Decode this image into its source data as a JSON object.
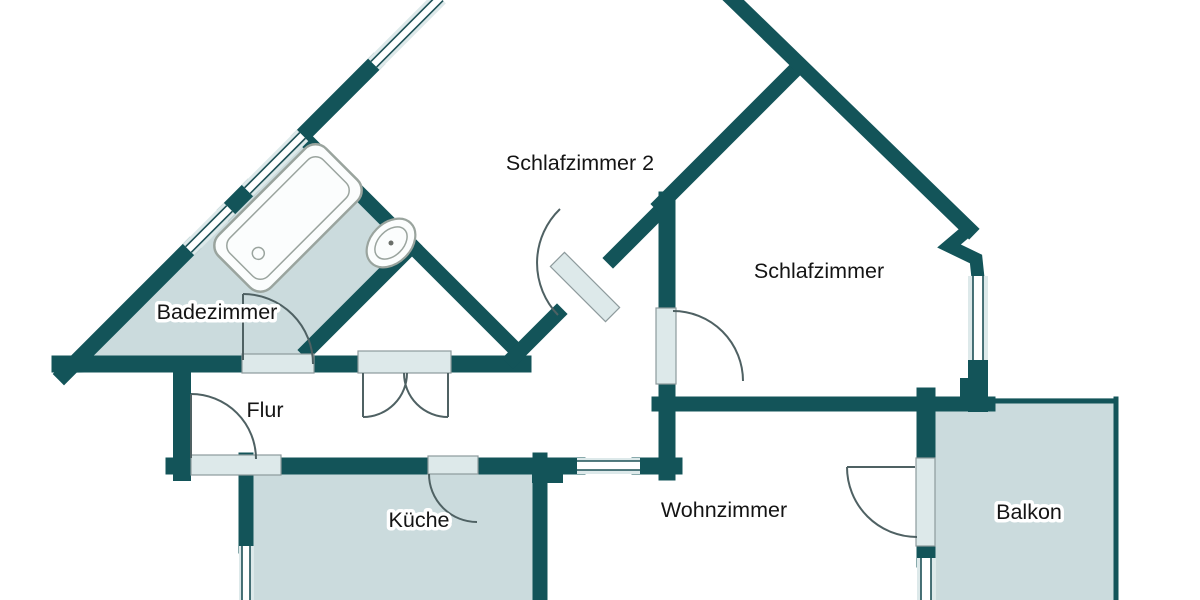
{
  "plan": {
    "type": "apartment-floor-plan",
    "rooms": {
      "schlafzimmer2": {
        "label": "Schlafzimmer 2"
      },
      "schlafzimmer": {
        "label": "Schlafzimmer"
      },
      "badezimmer": {
        "label": "Badezimmer"
      },
      "flur": {
        "label": "Flur"
      },
      "kueche": {
        "label": "Küche"
      },
      "wohnzimmer": {
        "label": "Wohnzimmer"
      },
      "balkon": {
        "label": "Balkon"
      }
    },
    "fixtures": {
      "bathtub": "bathtub-icon",
      "sink": "sink-icon"
    }
  },
  "colors": {
    "wall": "#135459",
    "room_fill": "#cbdbdd",
    "sill_fill": "#dde9ea",
    "fixture_outline": "#9aa49e",
    "arc_line": "#4f6163",
    "window_line": "#1d5056",
    "label_color": "#141414",
    "background": "#ffffff"
  }
}
